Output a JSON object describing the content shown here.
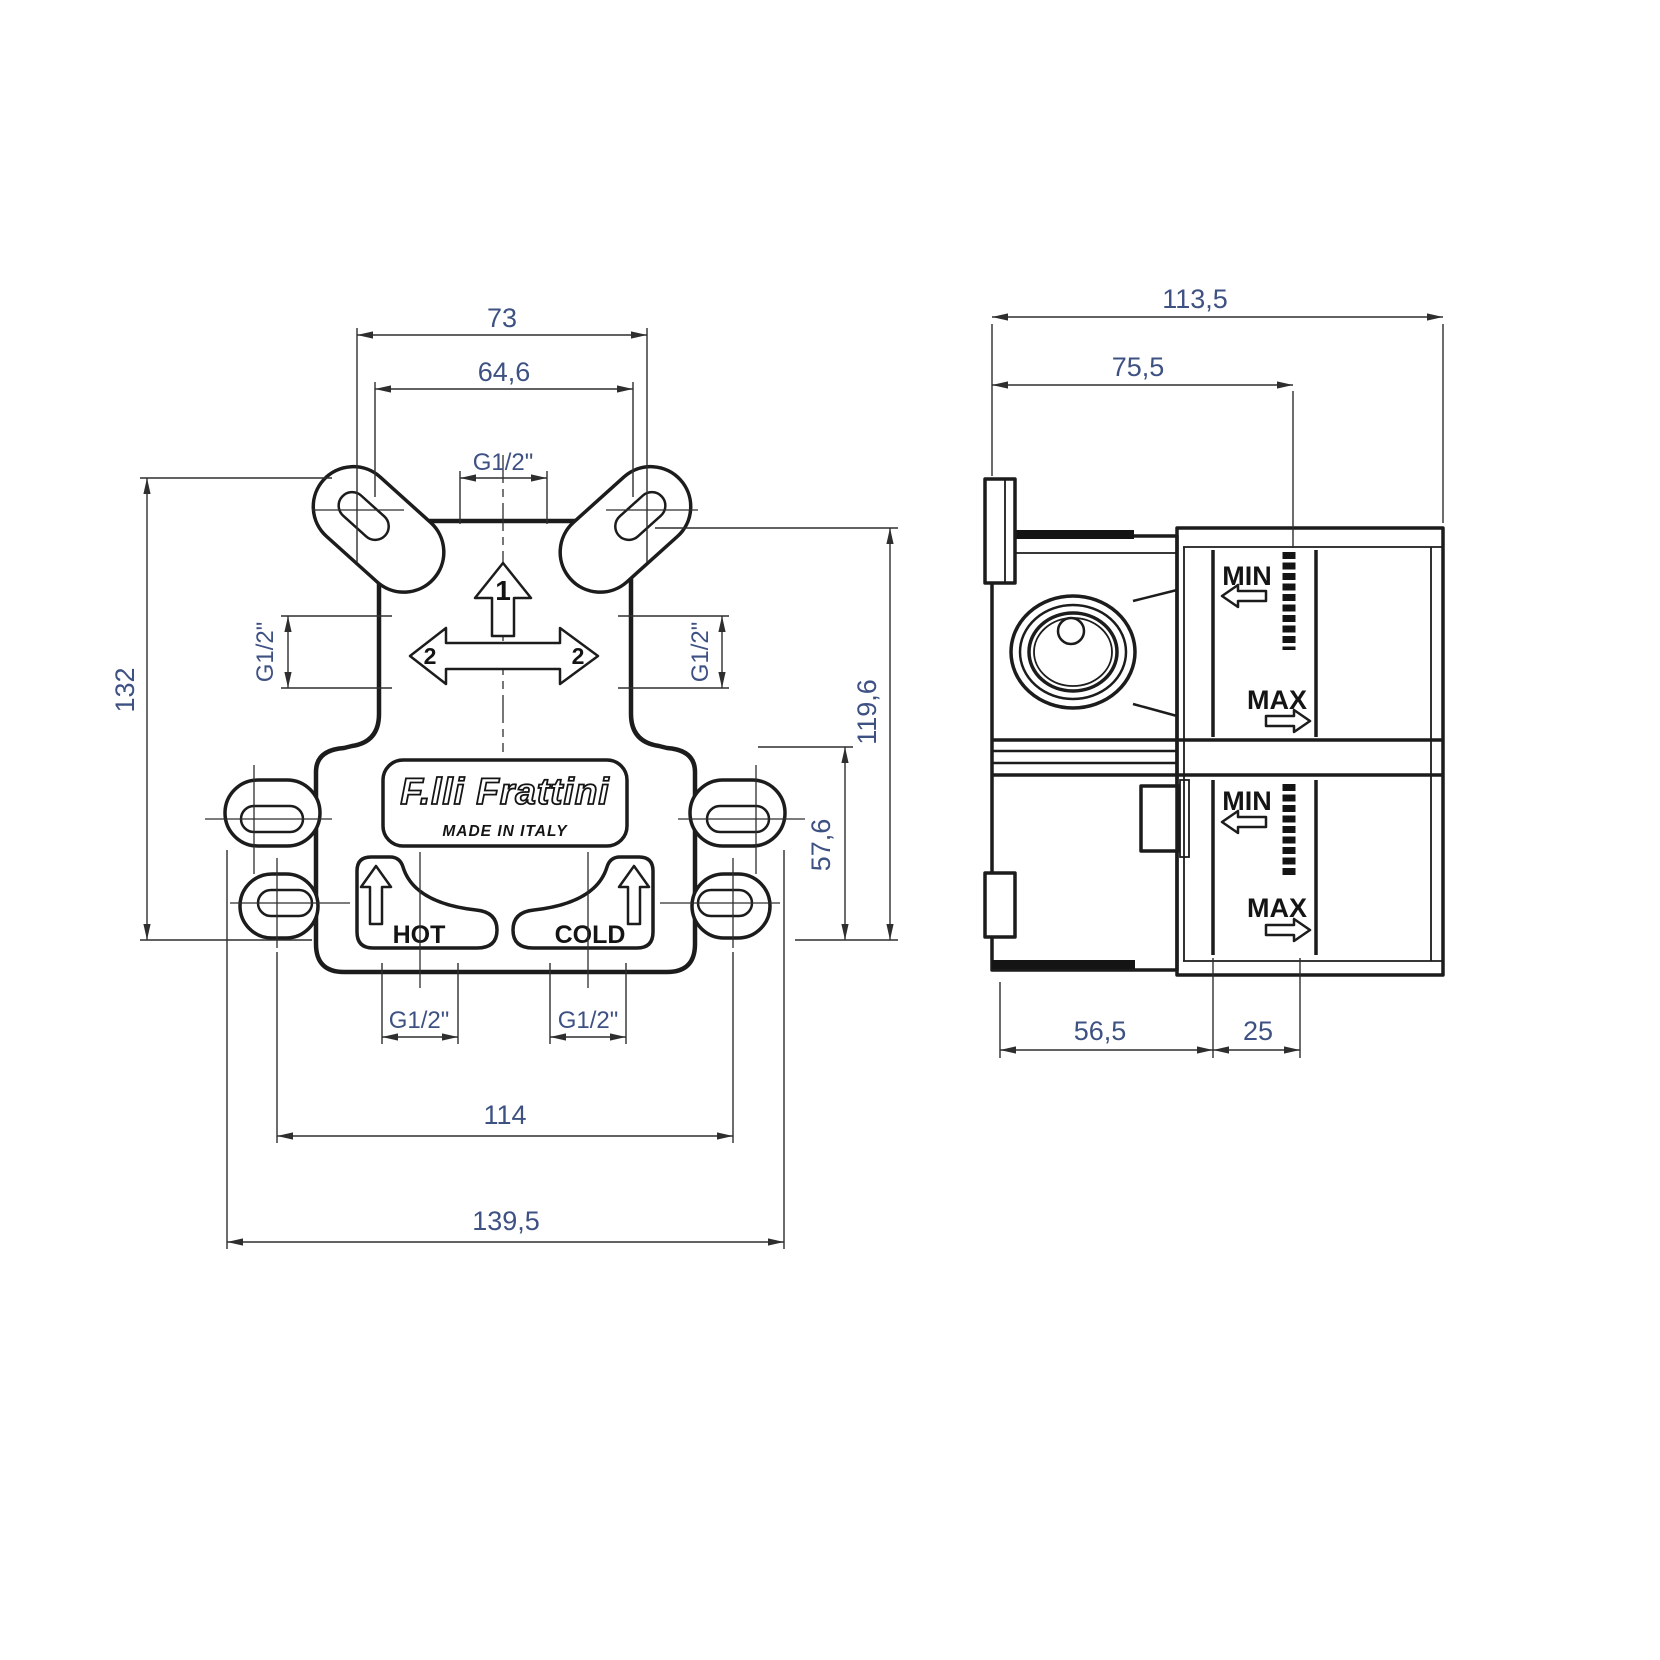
{
  "front_view": {
    "dims": {
      "lug_span_top": "73",
      "hole_span_top": "64,6",
      "port_top": "G1/2\"",
      "overall_height": "132",
      "port_left": "G1/2\"",
      "port_right": "G1/2\"",
      "body_height": "119,6",
      "lower_height": "57,6",
      "port_hot": "G1/2\"",
      "port_cold": "G1/2\"",
      "hole_span_bottom": "114",
      "overall_width": "139,5"
    },
    "markings": {
      "outlet_1": "1",
      "outlet_2_left": "2",
      "outlet_2_right": "2",
      "hot": "HOT",
      "cold": "COLD",
      "brand": "F.lli Frattini",
      "origin": "MADE IN ITALY"
    }
  },
  "side_view": {
    "dims": {
      "overall_depth": "113,5",
      "depth_to_marker": "75,5",
      "body_depth": "56,5",
      "adjust_range": "25"
    },
    "markings": {
      "upper_min": "MIN",
      "upper_max": "MAX",
      "lower_min": "MIN",
      "lower_max": "MAX"
    }
  },
  "colors": {
    "line": "#1c1c1c",
    "dim_text": "#3e5183",
    "background": "#ffffff"
  }
}
